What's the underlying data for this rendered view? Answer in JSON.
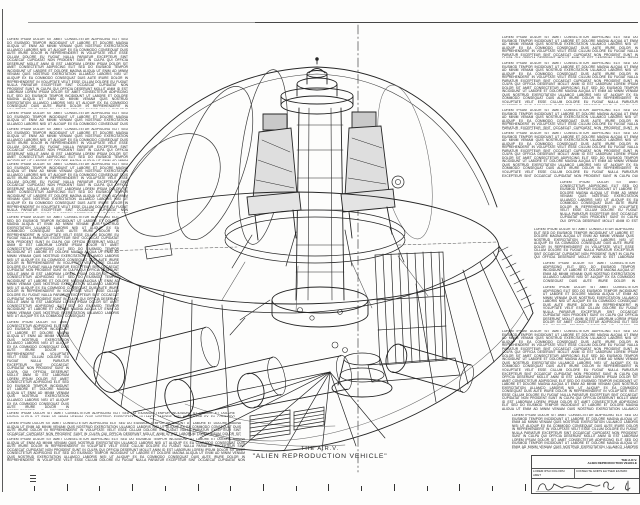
{
  "title": {
    "line1": "THE A.R.V.",
    "line2": "\"ALIEN REPRODUCTION VEHICLE\""
  },
  "annotations": {
    "legible": false,
    "filler": "LOREM IPSUM DOLOR SIT AMET CONSECTETUR ADIPISCING ELIT SED DO EIUSMOD TEMPOR INCIDIDUNT UT LABORE ET DOLORE MAGNA ALIQUA UT ENIM AD MINIM VENIAM QUIS NOSTRUD EXERCITATION ULLAMCO LABORIS NISI UT ALIQUIP EX EA COMMODO CONSEQUAT DUIS AUTE IRURE DOLOR IN REPREHENDERIT IN VOLUPTATE VELIT ESSE CILLUM DOLORE EU FUGIAT NULLA PARIATUR EXCEPTEUR SINT OCCAECAT CUPIDATAT NON PROIDENT SUNT IN CULPA QUI OFFICIA DESERUNT MOLLIT ANIM ID EST LABORUM LOREM IPSUM DOLOR SIT AMET CONSECTETUR ADIPISCING ELIT SED DO EIUSMOD TEMPOR INCIDIDUNT UT LABORE ET DOLORE MAGNA ALIQUA UT ENIM AD MINIM VENIAM QUIS NOSTRUD EXERCITATION ULLAMCO LABORIS NISI UT ALIQUIP EX EA COMMODO CONSEQUAT DUIS AUTE IRURE DOLOR IN REPREHENDERIT IN VOLUPTATE VELIT ESSE CILLUM DOLORE EU FUGIAT NULLA PARIATUR EXCEPTEUR SINT OCCAECAT CUPIDATAT NON PROIDENT SUNT IN CULPA QUI OFFICIA DESERUNT MOLLIT ANIM ID EST LABORUM LOREM IPSUM DOLOR SIT AMET CONSECTETUR ADIPISCING ELIT SED DO EIUSMOD TEMPOR INCIDIDUNT UT LABORE ET DOLORE MAGNA ALIQUA UT ENIM AD MINIM VENIAM QUIS NOSTRUD EXERCITATION ULLAMCO LABORIS NISI UT ALIQUIP EX EA COMMODO CONSEQUAT DUIS AUTE IRURE DOLOR IN REPREHENDERIT IN VOLUPTATE VELIT ESSE CILLUM DOLORE EU FUGIAT NULLA PARIATUR EXCEPTEUR SINT OCCAECAT CUPIDATAT NON PROIDENT SUNT IN CULPA QUI OFFICIA DESERUNT MOLLIT ANIM ID EST LABORUM LOREM IPSUM DOLOR SIT AMET CONSECTETUR ADIPISCING ELIT SED DO EIUSMOD TEMPOR INCIDIDUNT UT LABORE ET DOLORE MAGNA ALIQUA UT ENIM AD MINIM VENIAM QUIS NOSTRUD EXERCITATION ULLAMCO LABORIS NISI UT ALIQUIP EX EA COMMODO CONSEQUAT"
  },
  "title_block": {
    "name_line1": "THE A.R.V.",
    "name_line2": "ALIEN REPRODUCTION VEHICLE",
    "cell_a": "LOREM IPSU DOLORSI AMET",
    "cell_b": "CONSECTE ADIPIS ELITSED EIUSMO"
  },
  "scale_bar": {
    "tick_count": 16
  },
  "colors": {
    "ink": "#262626",
    "paper": "#fdfdfc",
    "faint_ink": "#666666"
  }
}
